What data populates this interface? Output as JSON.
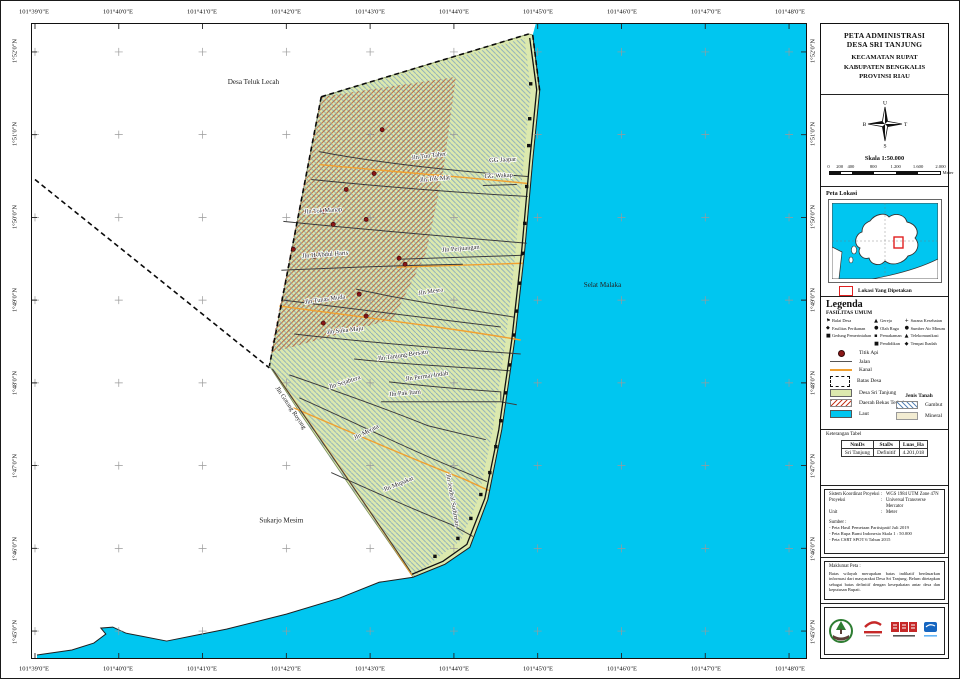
{
  "sheet": {
    "axes": {
      "top": [
        "101°39'0\"E",
        "101°40'0\"E",
        "101°41'0\"E",
        "101°42'0\"E",
        "101°43'0\"E",
        "101°44'0\"E",
        "101°45'0\"E",
        "101°46'0\"E",
        "101°47'0\"E",
        "101°48'0\"E"
      ],
      "bottom": [
        "101°39'0\"E",
        "101°40'0\"E",
        "101°41'0\"E",
        "101°42'0\"E",
        "101°43'0\"E",
        "101°44'0\"E",
        "101°45'0\"E",
        "101°46'0\"E",
        "101°47'0\"E",
        "101°48'0\"E"
      ],
      "left": [
        "1°52'0\"N",
        "1°51'0\"N",
        "1°50'0\"N",
        "1°49'0\"N",
        "1°48'0\"N",
        "1°47'0\"N",
        "1°46'0\"N",
        "1°45'0\"N"
      ],
      "right": [
        "1°52'0\"N",
        "1°51'0\"N",
        "1°50'0\"N",
        "1°49'0\"N",
        "1°48'0\"N",
        "1°47'0\"N",
        "1°46'0\"N",
        "1°45'0\"N"
      ]
    },
    "map": {
      "colors": {
        "sea": "#00c6f0",
        "village": "#dce9ae",
        "kanal": "#f0a030",
        "road": "#3d3d3d",
        "fire": "#8b1717",
        "gambut": "#6a93c0",
        "burnt": "#b04a28"
      },
      "area_labels": [
        {
          "text": "Desa Teluk Lecah",
          "x": 222,
          "y": 60
        },
        {
          "text": "Selat Malaka",
          "x": 572,
          "y": 264
        },
        {
          "text": "Sukarjo Mesim",
          "x": 250,
          "y": 500
        }
      ],
      "road_labels": [
        {
          "text": "Jln Tun Taher",
          "x": 398,
          "y": 134,
          "rot": -7
        },
        {
          "text": "GG Jaapar",
          "x": 472,
          "y": 138,
          "rot": -3
        },
        {
          "text": "GG Wakap",
          "x": 468,
          "y": 154,
          "rot": -3
        },
        {
          "text": "Jln Tok Mat",
          "x": 404,
          "y": 157,
          "rot": -5
        },
        {
          "text": "Jln Tok Manap",
          "x": 292,
          "y": 189,
          "rot": -4
        },
        {
          "text": "Jln H Abdul Haris",
          "x": 294,
          "y": 233,
          "rot": -4
        },
        {
          "text": "Jln Perjuangan",
          "x": 430,
          "y": 227,
          "rot": -5
        },
        {
          "text": "Jln Mesra",
          "x": 400,
          "y": 270,
          "rot": -9
        },
        {
          "text": "Jln Tunas Muda",
          "x": 294,
          "y": 278,
          "rot": -8
        },
        {
          "text": "Jln Suka Maju",
          "x": 314,
          "y": 309,
          "rot": -6
        },
        {
          "text": "Jln Tanjung Bersatu",
          "x": 372,
          "y": 334,
          "rot": -8
        },
        {
          "text": "Jln Permai Indah",
          "x": 396,
          "y": 355,
          "rot": -8
        },
        {
          "text": "Jln Pak Itam",
          "x": 374,
          "y": 372,
          "rot": -5
        },
        {
          "text": "Jln Sejahtera",
          "x": 314,
          "y": 361,
          "rot": -18
        },
        {
          "text": "Jln Merata",
          "x": 336,
          "y": 411,
          "rot": -27
        },
        {
          "text": "Jln Mupakat",
          "x": 368,
          "y": 463,
          "rot": -22
        },
        {
          "text": "Jln Gotong Royong",
          "x": 258,
          "y": 386,
          "rot": 56
        },
        {
          "text": "Jln Jendral Sudirman",
          "x": 420,
          "y": 478,
          "rot": 80
        }
      ],
      "fire_points": [
        [
          351,
          106
        ],
        [
          343,
          150
        ],
        [
          315,
          166
        ],
        [
          292,
          188
        ],
        [
          302,
          201
        ],
        [
          335,
          196
        ],
        [
          262,
          226
        ],
        [
          283,
          233
        ],
        [
          368,
          235
        ],
        [
          374,
          241
        ],
        [
          328,
          271
        ],
        [
          335,
          293
        ],
        [
          292,
          300
        ]
      ],
      "facility_points": [
        [
          500,
          60
        ],
        [
          499,
          95
        ],
        [
          498,
          122
        ],
        [
          496,
          163
        ],
        [
          494,
          200
        ],
        [
          492,
          230
        ],
        [
          489,
          260
        ],
        [
          486,
          288
        ],
        [
          483,
          312
        ],
        [
          479,
          342
        ],
        [
          475,
          370
        ],
        [
          470,
          398
        ],
        [
          465,
          424
        ],
        [
          459,
          450
        ],
        [
          450,
          472
        ],
        [
          440,
          496
        ],
        [
          427,
          516
        ],
        [
          404,
          534
        ]
      ]
    }
  },
  "panel": {
    "title": [
      "PETA ADMINISTRASI",
      "DESA SRI TANJUNG",
      "KECAMATAN RUPAT",
      "KABUPATEN BENGKALIS",
      "PROVINSI RIAU"
    ],
    "compass": {
      "n": "U",
      "e": "T",
      "s": "S",
      "w": "B"
    },
    "skala": "Skala 1:50.000",
    "scalebar": {
      "ticks": [
        "0",
        "200",
        "400",
        "800",
        "1.200",
        "1.600",
        "2.000"
      ],
      "values": [
        0,
        200,
        400,
        800,
        1200,
        1600,
        2000
      ],
      "unit": "Meter"
    },
    "lokasi": {
      "title": "Peta Lokasi",
      "legend": "Lokasi Yang Dipetakan"
    },
    "legenda": {
      "title": "Legenda",
      "fasilitas_title": "FASILITAS UMUM",
      "fasilitas_columns": [
        [
          {
            "icon": "balai-desa-icon",
            "glyph": "⚑",
            "label": "Balai Desa"
          },
          {
            "icon": "fasilitas-perikanan-icon",
            "glyph": "◆",
            "label": "Fasilitas Perikanan"
          },
          {
            "icon": "gedung-pemerintahan-icon",
            "glyph": "■",
            "label": "Gedung Pemerintahan"
          }
        ],
        [
          {
            "icon": "gereja-icon",
            "glyph": "▲",
            "label": "Gereja"
          },
          {
            "icon": "olah-raga-icon",
            "glyph": "●",
            "label": "Olah Raga"
          },
          {
            "icon": "pemakaman-icon",
            "glyph": "▪",
            "label": "Pemakaman"
          },
          {
            "icon": "pendidikan-icon",
            "glyph": "■",
            "label": "Pendidikan"
          }
        ],
        [
          {
            "icon": "sarana-kesehatan-icon",
            "glyph": "+",
            "label": "Sarana Kesehatan"
          },
          {
            "icon": "sumber-air-minum-icon",
            "glyph": "●",
            "label": "Sumber Air Minum"
          },
          {
            "icon": "telekomunikasi-icon",
            "glyph": "▲",
            "label": "Telekomunikasi"
          },
          {
            "icon": "tempat-ibadah-icon",
            "glyph": "◆",
            "label": "Tempat Ibadah"
          }
        ]
      ],
      "symbols": [
        {
          "type": "dot",
          "label": "Titik Api"
        },
        {
          "type": "road",
          "label": "Jalan"
        },
        {
          "type": "kanal",
          "label": "Kanal"
        },
        {
          "type": "batas",
          "label": "Batas Desa"
        },
        {
          "type": "village",
          "label": "Desa Sri Tanjung"
        },
        {
          "type": "burnt",
          "label": "Daerah Bekas Terbakar"
        },
        {
          "type": "laut",
          "label": "Laut"
        }
      ],
      "jenis_tanah": {
        "title": "Jenis Tanah",
        "items": [
          {
            "type": "gambut",
            "label": "Gambut"
          },
          {
            "type": "mineral",
            "label": "Mineral"
          }
        ]
      }
    },
    "keterangan": {
      "title": "Keterangan Tabel",
      "headers": [
        "NmDs",
        "StaDs",
        "Luas_Ha"
      ],
      "rows": [
        [
          "Sri Tanjung",
          "Definitif",
          "4.201,018"
        ]
      ]
    },
    "koordinat": [
      [
        "Sistem Koordinat Proyeksi",
        "WGS 1984 UTM Zone 47N"
      ],
      [
        "Proyeksi",
        "Universal Transverse Mercator"
      ],
      [
        "Unit",
        "Meter"
      ]
    ],
    "sumber": {
      "title": "Sumber :",
      "items": [
        "- Peta Hasil Pemetaan Partisipatif Juli 2019",
        "- Peta Rupa Bumi Indonesia Skala 1 : 50.000",
        "- Peta CSRT SPOT 6 Tahun 2015"
      ]
    },
    "maklumat": {
      "title": "Maklumat Peta :",
      "text": "Batas wilayah merupakan batas indikatif berdasarkan informasi dari masyarakat Desa Sri Tanjung. Belum ditetapkan sebagai batas definitif dengan kesepakatan antar desa dan keputusan Bupati."
    }
  }
}
